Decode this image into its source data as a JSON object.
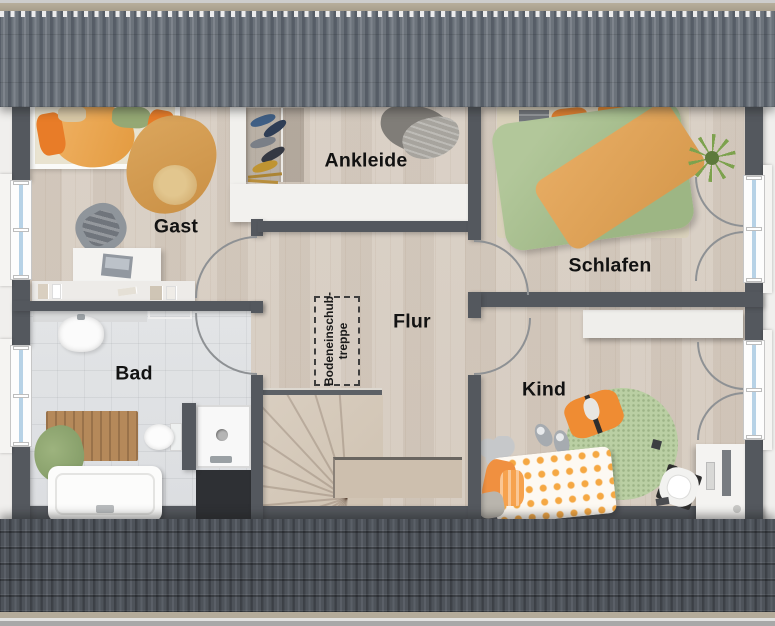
{
  "plan": {
    "type": "floor-plan",
    "rooms": [
      {
        "id": "gast",
        "label": "Gast"
      },
      {
        "id": "ankleide",
        "label": "Ankleide"
      },
      {
        "id": "schlafen",
        "label": "Schlafen"
      },
      {
        "id": "flur",
        "label": "Flur"
      },
      {
        "id": "bad",
        "label": "Bad"
      },
      {
        "id": "kind",
        "label": "Kind"
      }
    ],
    "annotations": {
      "attic_hatch_label": "Bodeneinschub-\ntreppe"
    },
    "colors": {
      "wall": "#54585e",
      "wood_floor": "#d7cdc2",
      "tile_floor": "#e0e2e4",
      "roof_top": "#6a7179",
      "roof_bottom": "#4b5056",
      "accent_orange": "#e8892f",
      "accent_green": "#a3bd8c",
      "window_glass": "#b7d2e6"
    }
  }
}
